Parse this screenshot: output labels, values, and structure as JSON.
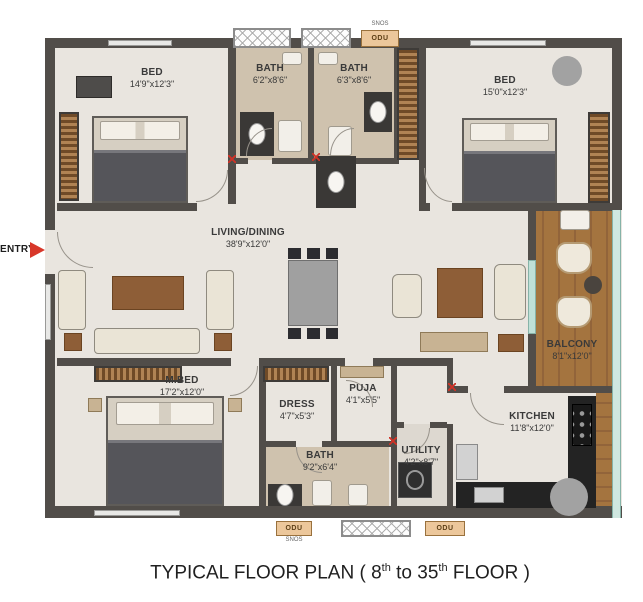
{
  "plan": {
    "title": {
      "part1": "TYPICAL FLOOR PLAN ( 8",
      "sup1": "th",
      "part2": " to 35",
      "sup2": "th",
      "part3": " FLOOR )"
    },
    "entry_label": "ENTRY"
  },
  "rooms": {
    "bed1": {
      "name": "BED",
      "dims": "14'9\"x12'3\""
    },
    "bath1": {
      "name": "BATH",
      "dims": "6'2\"x8'6\""
    },
    "bath2": {
      "name": "BATH",
      "dims": "6'3\"x8'6\""
    },
    "bed2": {
      "name": "BED",
      "dims": "15'0\"x12'3\""
    },
    "living": {
      "name": "LIVING/DINING",
      "dims": "38'9\"x12'0\""
    },
    "balcony": {
      "name": "BALCONY",
      "dims": "8'1\"x12'0\""
    },
    "mbed": {
      "name": "M.BED",
      "dims": "17'2\"x12'0\""
    },
    "dress": {
      "name": "DRESS",
      "dims": "4'7\"x5'3\""
    },
    "puja": {
      "name": "PUJA",
      "dims": "4'1\"x5'5\""
    },
    "bath3": {
      "name": "BATH",
      "dims": "9'2\"x6'4\""
    },
    "utility": {
      "name": "UTILITY",
      "dims": "4'2\"x8'7\""
    },
    "kitchen": {
      "name": "KITCHEN",
      "dims": "11'8\"x12'0\""
    }
  },
  "service": {
    "odu_labels": [
      "ODU",
      "ODU",
      "ODU"
    ],
    "svcs_labels": [
      "SNOS",
      "SNOS"
    ]
  },
  "colors": {
    "wall": "#514d49",
    "floor": "#e9e5df",
    "bath_floor": "#cfc2ae",
    "balcony_wood": "#a4743f",
    "wardrobe": "#6f4a27",
    "odu_fill": "#ecc79b",
    "entry_red": "#d8372a",
    "glass": "#cfe7e0",
    "counter": "#232323"
  }
}
